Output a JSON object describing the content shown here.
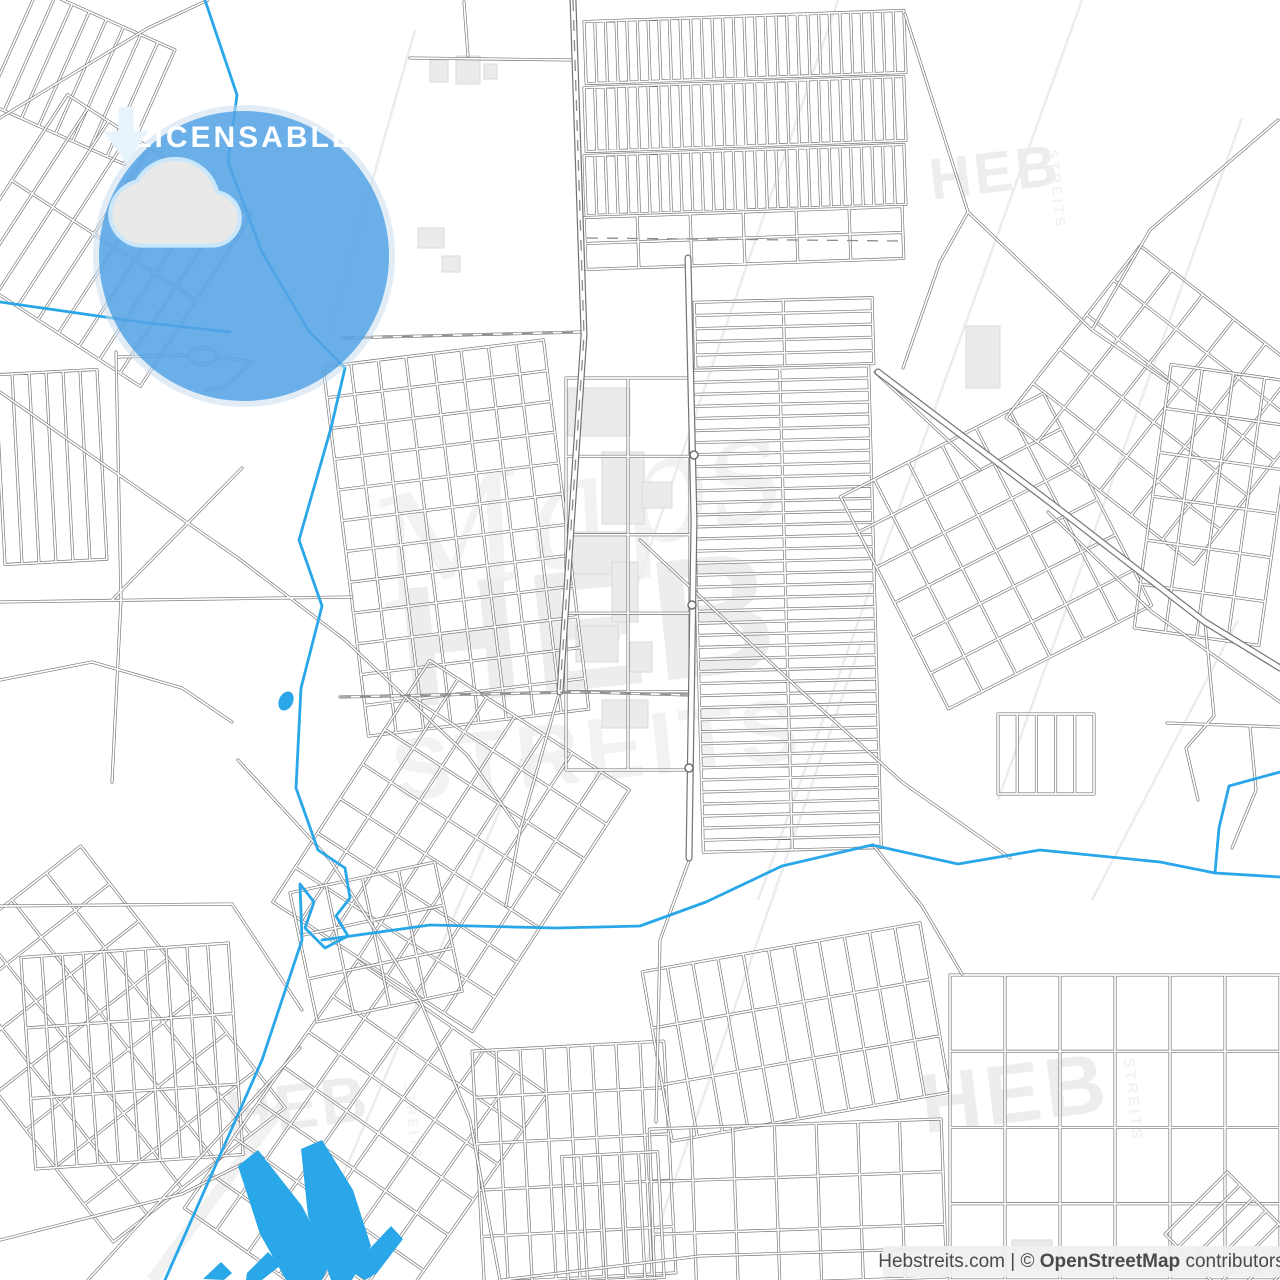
{
  "page": {
    "width": 1280,
    "height": 1280,
    "background": "#ffffff"
  },
  "map": {
    "type": "street-map",
    "land_color": "#ffffff",
    "road_casing_color": "#737373",
    "road_fill_color": "#ffffff",
    "dash_color": "#8c8c8c",
    "water_color": "#29A7E8",
    "building_fill": "#ebebeb",
    "building_stroke": "#d9d9d9",
    "scratch_color": "#ececec"
  },
  "badge": {
    "label": "LICENSABLE",
    "circle_color": "rgba(85,164,229,0.88)",
    "ring_color": "rgba(203,221,238,0.55)",
    "cloud_fill": "#E9EAE8",
    "cloud_outline": "#C9E6FA",
    "arrow_color": "#E8F4FC",
    "label_color": "#FDFEFF"
  },
  "watermarks": {
    "brand": "HEB",
    "sub": "STREITS",
    "script": "Maps",
    "color": "#EDEDED",
    "sub_color": "#F2F2F2"
  },
  "attribution": {
    "site": "Hebstreits.com",
    "separator": " | ",
    "copyright": "© ",
    "osm": "OpenStreetMap",
    "suffix": "contributors",
    "background": "rgba(240,240,240,0.93)",
    "text_color": "#4a4a4a"
  }
}
